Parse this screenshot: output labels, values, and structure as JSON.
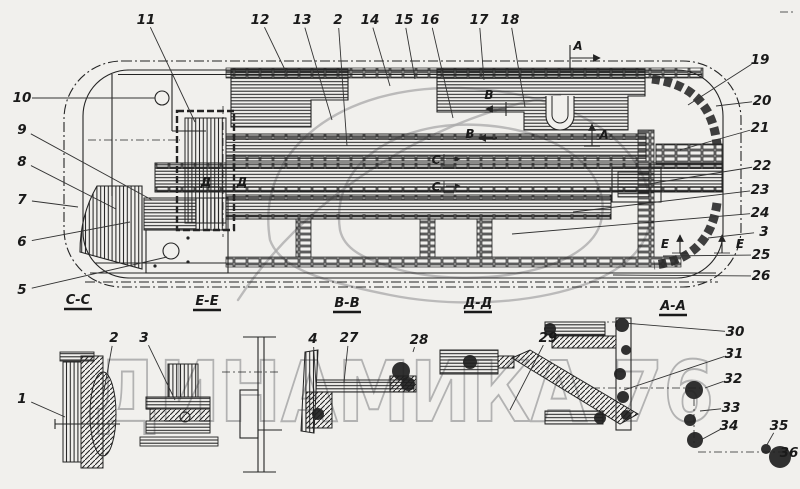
{
  "colors": {
    "paper": "#f1f0ed",
    "ink": "#242424",
    "leader": "#333333",
    "watermark": "#a8a8a8"
  },
  "watermark": {
    "text": "ДИНАМИКА 76"
  },
  "main_view": {
    "title_hint": "floor-frame-plan-view",
    "callouts": [
      {
        "label": "11",
        "x": 146,
        "y": 20,
        "tx": 195,
        "ty": 122
      },
      {
        "label": "12",
        "x": 260,
        "y": 20,
        "tx": 288,
        "ty": 76
      },
      {
        "label": "13",
        "x": 302,
        "y": 20,
        "tx": 332,
        "ty": 120
      },
      {
        "label": "2",
        "x": 338,
        "y": 20,
        "tx": 347,
        "ty": 146
      },
      {
        "label": "14",
        "x": 370,
        "y": 20,
        "tx": 390,
        "ty": 86
      },
      {
        "label": "15",
        "x": 404,
        "y": 20,
        "tx": 415,
        "ty": 79
      },
      {
        "label": "16",
        "x": 430,
        "y": 20,
        "tx": 453,
        "ty": 118
      },
      {
        "label": "17",
        "x": 479,
        "y": 20,
        "tx": 484,
        "ty": 80
      },
      {
        "label": "18",
        "x": 510,
        "y": 20,
        "tx": 525,
        "ty": 107
      },
      {
        "label": "10",
        "x": 22,
        "y": 98,
        "tx": 155,
        "ty": 98
      },
      {
        "label": "9",
        "x": 22,
        "y": 130,
        "tx": 152,
        "ty": 200
      },
      {
        "label": "8",
        "x": 22,
        "y": 162,
        "tx": 116,
        "ty": 209
      },
      {
        "label": "7",
        "x": 22,
        "y": 200,
        "tx": 78,
        "ty": 207
      },
      {
        "label": "6",
        "x": 22,
        "y": 242,
        "tx": 130,
        "ty": 222
      },
      {
        "label": "5",
        "x": 22,
        "y": 290,
        "tx": 167,
        "ty": 257
      },
      {
        "label": "19",
        "x": 760,
        "y": 60,
        "tx": 688,
        "ty": 105
      },
      {
        "label": "20",
        "x": 762,
        "y": 101,
        "tx": 716,
        "ty": 106
      },
      {
        "label": "21",
        "x": 760,
        "y": 128,
        "tx": 680,
        "ty": 150
      },
      {
        "label": "22",
        "x": 762,
        "y": 166,
        "tx": 648,
        "ty": 184
      },
      {
        "label": "23",
        "x": 760,
        "y": 190,
        "tx": 573,
        "ty": 212
      },
      {
        "label": "24",
        "x": 760,
        "y": 213,
        "tx": 512,
        "ty": 234
      },
      {
        "label": "3",
        "x": 764,
        "y": 232,
        "tx": 708,
        "ty": 238
      },
      {
        "label": "25",
        "x": 761,
        "y": 255,
        "tx": 663,
        "ty": 256
      },
      {
        "label": "26",
        "x": 761,
        "y": 276,
        "tx": 613,
        "ty": 275
      }
    ],
    "letters": [
      {
        "label": "А",
        "x": 578,
        "y": 50
      },
      {
        "label": "А",
        "x": 604,
        "y": 139
      },
      {
        "label": "В",
        "x": 489,
        "y": 99
      },
      {
        "label": "В",
        "x": 470,
        "y": 138
      },
      {
        "label": "С",
        "x": 436,
        "y": 164
      },
      {
        "label": "С",
        "x": 436,
        "y": 191
      },
      {
        "label": "Д",
        "x": 206,
        "y": 186
      },
      {
        "label": "Д",
        "x": 242,
        "y": 186
      },
      {
        "label": "Е",
        "x": 665,
        "y": 248
      },
      {
        "label": "Е",
        "x": 740,
        "y": 248
      }
    ]
  },
  "section_labels": [
    {
      "label": "С-С",
      "x": 78,
      "y": 304
    },
    {
      "label": "Е-Е",
      "x": 207,
      "y": 305
    },
    {
      "label": "В-В",
      "x": 347,
      "y": 307
    },
    {
      "label": "Д-Д",
      "x": 478,
      "y": 307
    },
    {
      "label": "А-А",
      "x": 673,
      "y": 310
    }
  ],
  "details": {
    "callouts": [
      {
        "label": "1",
        "x": 22,
        "y": 399,
        "tx": 65,
        "ty": 417
      },
      {
        "label": "2",
        "x": 114,
        "y": 338,
        "tx": 103,
        "ty": 396
      },
      {
        "label": "3",
        "x": 144,
        "y": 338,
        "tx": 175,
        "ty": 400
      },
      {
        "label": "4",
        "x": 313,
        "y": 339,
        "tx": 316,
        "ty": 385
      },
      {
        "label": "27",
        "x": 349,
        "y": 338,
        "tx": 344,
        "ty": 382
      },
      {
        "label": "28",
        "x": 419,
        "y": 340,
        "tx": 413,
        "ty": 352
      },
      {
        "label": "29",
        "x": 548,
        "y": 338,
        "tx": 510,
        "ty": 410
      },
      {
        "label": "30",
        "x": 735,
        "y": 332,
        "tx": 624,
        "ty": 323
      },
      {
        "label": "31",
        "x": 734,
        "y": 354,
        "tx": 624,
        "ty": 390
      },
      {
        "label": "32",
        "x": 733,
        "y": 379,
        "tx": 705,
        "ty": 388
      },
      {
        "label": "33",
        "x": 731,
        "y": 408,
        "tx": 700,
        "ty": 411
      },
      {
        "label": "34",
        "x": 729,
        "y": 426,
        "tx": 697,
        "ty": 442
      },
      {
        "label": "35",
        "x": 779,
        "y": 426,
        "tx": 764,
        "ty": 450
      },
      {
        "label": "36",
        "x": 789,
        "y": 453,
        "tx": 780,
        "ty": 458
      }
    ]
  }
}
